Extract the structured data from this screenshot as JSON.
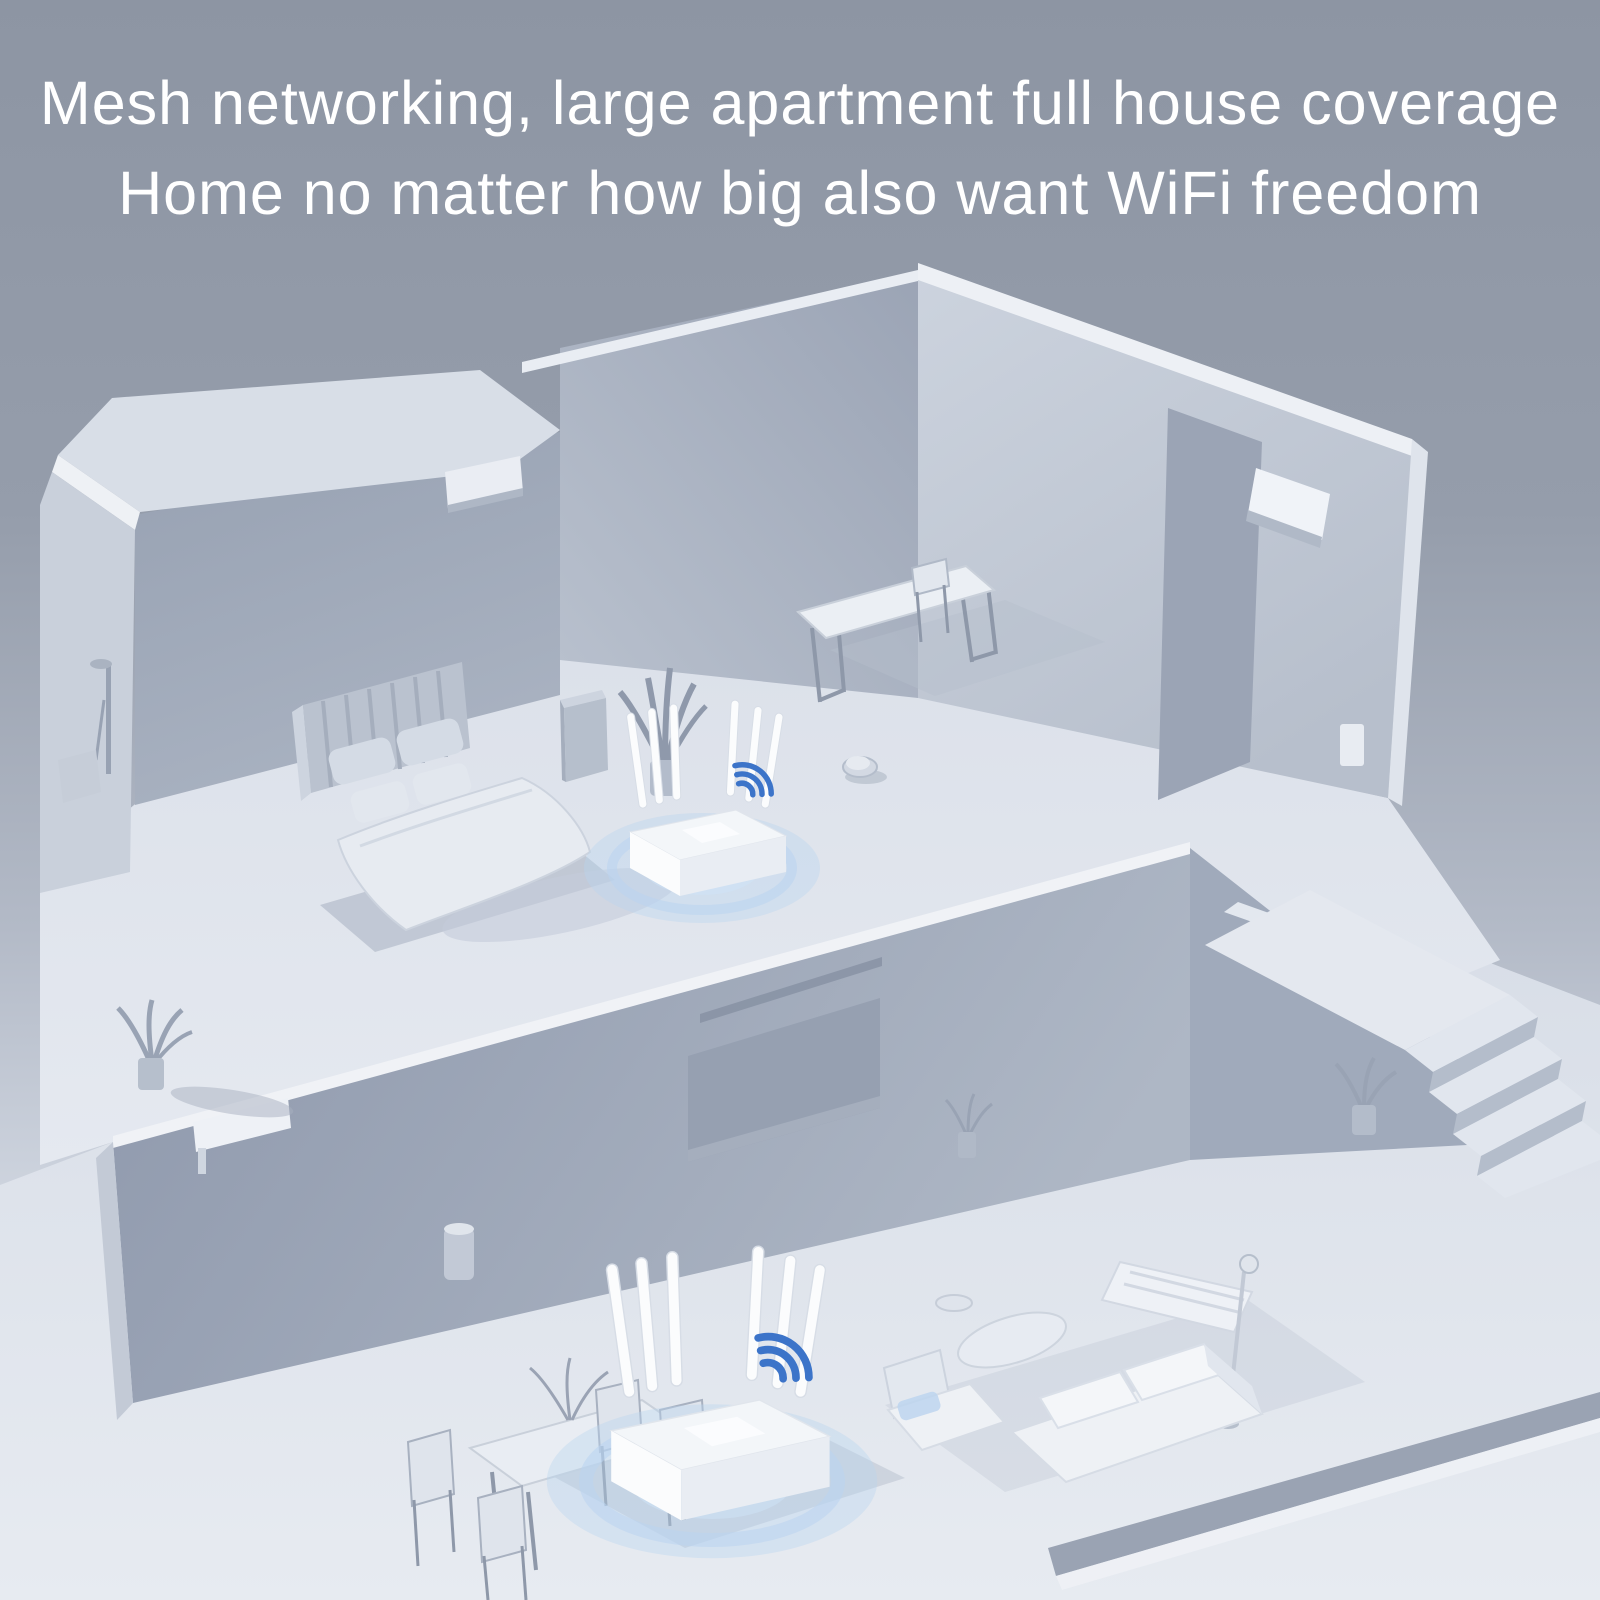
{
  "headline": {
    "line1": "Mesh networking, large apartment full house coverage",
    "line2": "Home no matter how big also want WiFi freedom"
  },
  "theme": {
    "bg_top": "#8d95a3",
    "bg_bottom": "#e6eaf0",
    "headline_color": "#ffffff",
    "wifi_blue": "#3c74c9",
    "glow_blue": "#b9d4f0",
    "router_white": "#fbfcfd",
    "wall_dark": "#9aa3b4",
    "wall_mid": "#b7bfcc",
    "floor_light": "#dfe4ec",
    "shadow": "#b3bcca"
  },
  "scene": {
    "style": "isometric 3D cutaway render of a two-storey apartment, monochrome grey-blue",
    "levels": [
      "upper floor",
      "lower floor"
    ],
    "routers": [
      {
        "location": "upper floor, bedroom level",
        "antenna_count": 6,
        "signal_arcs": 3
      },
      {
        "location": "lower floor, living area",
        "antenna_count": 6,
        "signal_arcs": 3
      }
    ],
    "objects": [
      "bed with slatted headboard and four pillows",
      "tall potted plant beside bed",
      "bedside cabinet",
      "long dining table with chair (upper floor)",
      "robot vacuum",
      "wall air-conditioner vent (bedroom wall)",
      "wall air-conditioner unit (right block)",
      "shower fixture on outer left wall",
      "staircase with landing and lower steps",
      "potted plant at stair base",
      "potted plant on mezzanine edge",
      "recessed TV panel on mid wall",
      "white wall shelf vent on mid wall",
      "small potted plant near TV wall",
      "dining table with four chairs (lower floor)",
      "table centerpiece plant sprigs",
      "lounge chair with blue cushion",
      "three-seat sofa with back cushions",
      "console shelf",
      "floor lamp",
      "curved coffee table",
      "cylindrical waste bin",
      "diagonal floor ledge step"
    ]
  }
}
